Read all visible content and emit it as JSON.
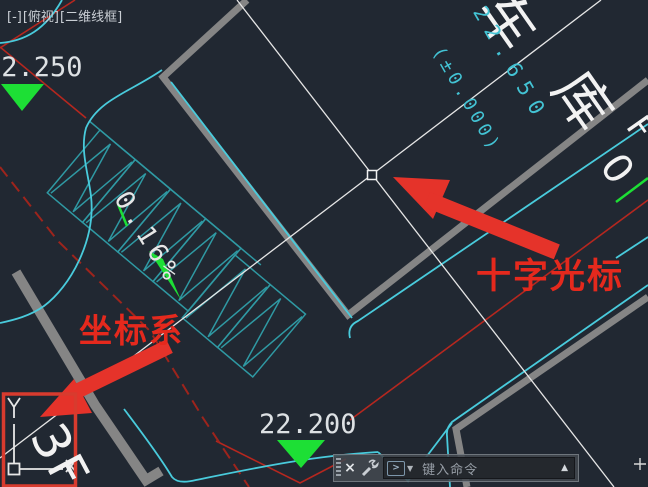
{
  "viewport": {
    "menu": "[-]",
    "view": "[俯视]",
    "style": "[二维线框]"
  },
  "elevations": {
    "topleft": "22.250",
    "bottom": "22.200",
    "rotated_value": "22.650",
    "rotated_datum": "(±0.000)"
  },
  "labels": {
    "slope": "0.16%",
    "floor": "3F",
    "garage_char_1": "车",
    "garage_char_2": "库",
    "edge_char_f": "F",
    "edge_char_0": "0"
  },
  "annotations": {
    "crosshair": "十字光标",
    "ucs": "坐标系"
  },
  "ucs_icon": {
    "x_label": "X",
    "y_label": "Y"
  },
  "command_bar": {
    "close": "×",
    "prompt": ">",
    "dropdown": "▼",
    "placeholder": "键入命令",
    "recent": "▲"
  },
  "colors": {
    "background": "#212832",
    "cad_red": "#b5271f",
    "cad_red_dashed": "#9e241c",
    "cad_cyan": "#49cbdc",
    "cad_teal": "#2f99a3",
    "cad_gray_wall": "#858585",
    "cad_green": "#1ddf35",
    "crosshair_white": "#e6e6e6",
    "annotation_red": "#e5291d",
    "text_white": "#dde1e4"
  }
}
